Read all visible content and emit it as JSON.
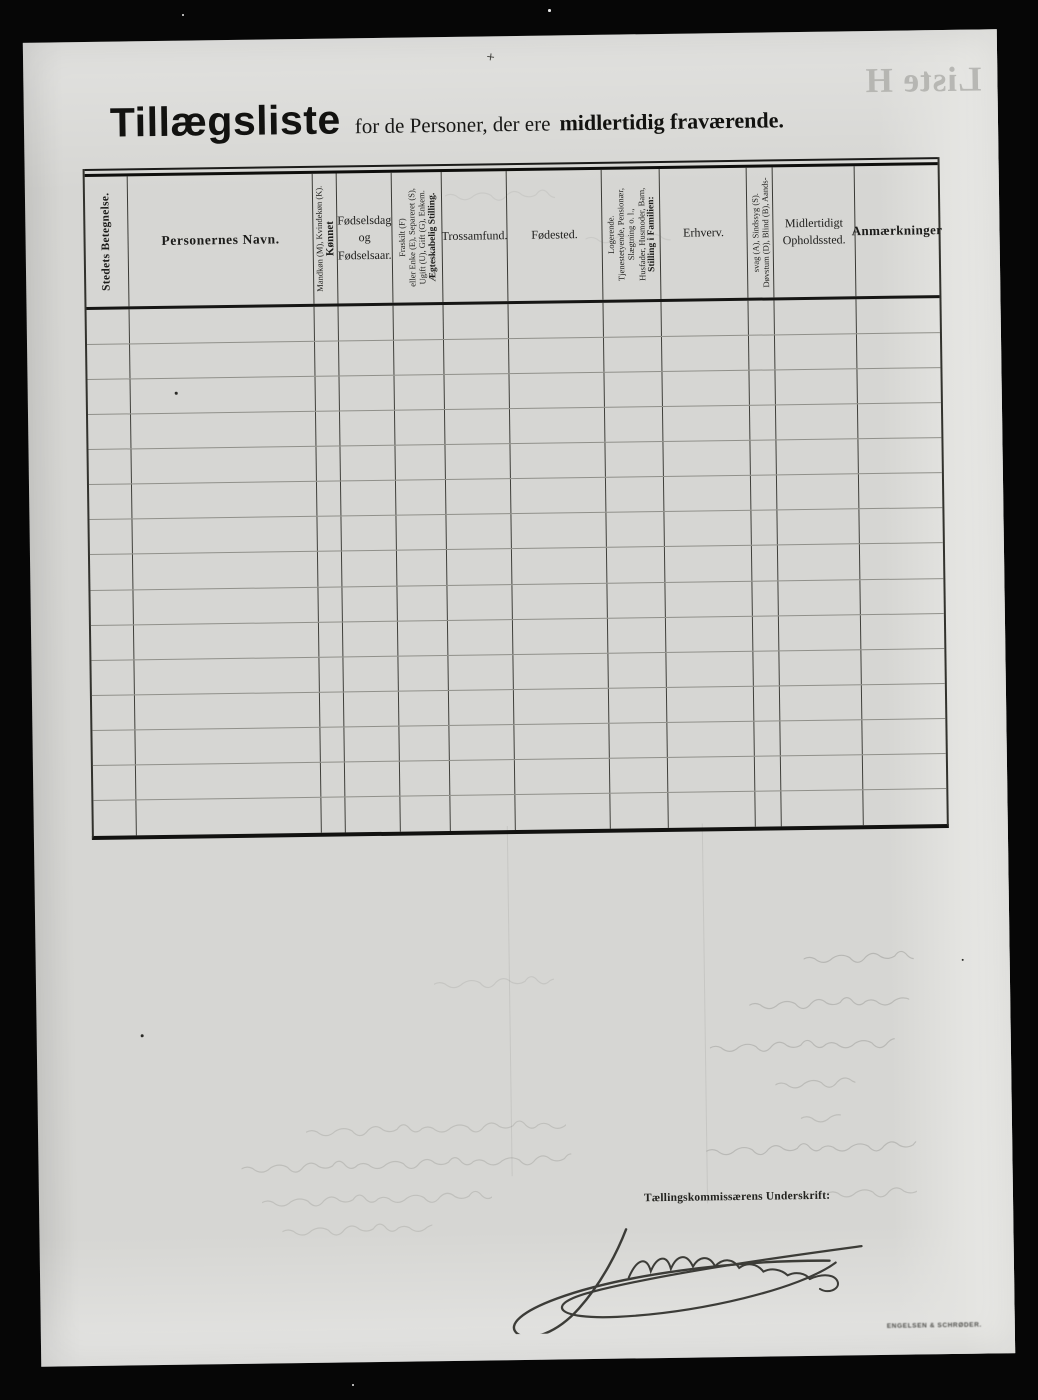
{
  "document": {
    "title_main": "Tillægsliste",
    "title_rest": "for de Personer, der ere",
    "title_bold": "midlertidig fraværende."
  },
  "table": {
    "columns": [
      {
        "id": "stedets-betegnelse",
        "lines": [
          "Stedets Betegnelse."
        ]
      },
      {
        "id": "personernes-navn",
        "lines": [
          "Personernes Navn."
        ]
      },
      {
        "id": "koennet",
        "lines": [
          "Kønnet",
          "Mandkøn (M), Kvindekøn (K)."
        ]
      },
      {
        "id": "foedselsdag",
        "lines": [
          "Fødselsdag",
          "og",
          "Fødselsaar."
        ]
      },
      {
        "id": "aegteskabelig-stilling",
        "lines": [
          "Ægteskabelig Stilling.",
          "Ugift (U), Gift (G), Enkem.",
          "eller Enke (E), Separeret (S),",
          "Fraskilt (F)"
        ]
      },
      {
        "id": "trossamfund",
        "lines": [
          "Trossamfund."
        ]
      },
      {
        "id": "foedested",
        "lines": [
          "Fødested."
        ]
      },
      {
        "id": "stilling-i-familien",
        "lines": [
          "Stilling i Familien:",
          "Husfader, Husmoder, Barn,",
          "Slægtning o. l.,",
          "Tjenestetyende, Pensionær,",
          "Logerende."
        ]
      },
      {
        "id": "erhverv",
        "lines": [
          "Erhverv."
        ]
      },
      {
        "id": "doevstum",
        "lines": [
          "Døvstum (D), Blind (B), Aands-",
          "svag (A), Sindssyg (S)."
        ]
      },
      {
        "id": "midlertidigt-opholdssted",
        "lines": [
          "Midlertidigt",
          "Opholdssted."
        ]
      },
      {
        "id": "anmaerkninger",
        "lines": [
          "Anmærkninger"
        ]
      }
    ],
    "row_count": 15,
    "rows_content": "empty (no entries filled in)"
  },
  "footer": {
    "signature_caption": "Tællingskommissærens Underskrift:",
    "signature": "handwritten signature (illegible cursive)",
    "printer_imprint": "ENGELSEN & SCHRØDER."
  },
  "bleedthrough": {
    "mirrored_heading": "Liste H"
  }
}
